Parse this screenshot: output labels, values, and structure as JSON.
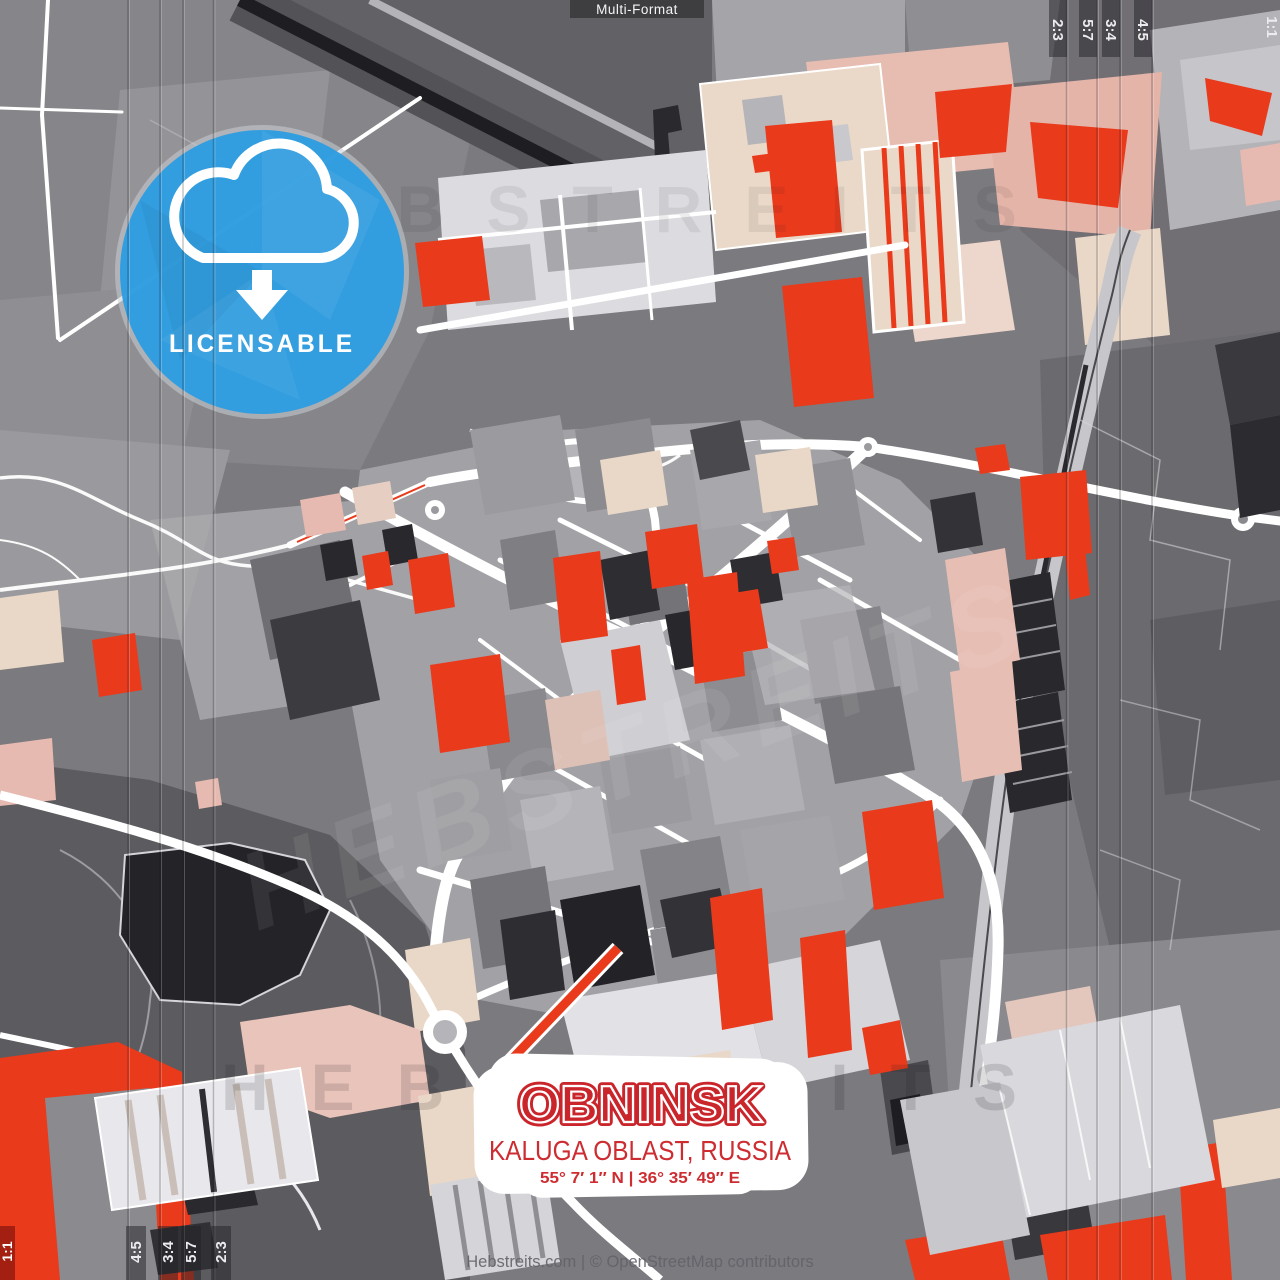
{
  "poster": {
    "format_label": "Multi-Format",
    "badge": {
      "label": "LICENSABLE",
      "color": "#2d9de1",
      "icon": "cloud-download-icon"
    },
    "title": {
      "city": "OBNINSK",
      "region": "KALUGA OBLAST, RUSSIA",
      "coordinates": "55° 7′ 1′′ N | 36° 35′ 49′′ E"
    },
    "watermark": {
      "text": "HEBSTREITS"
    },
    "footer_credit": "Hebstreits.com | © OpenStreetMap contributors",
    "format_marks": {
      "top_labels": [
        "2:3",
        "5:7",
        "3:4",
        "4:5"
      ],
      "bottom_labels": [
        "4:5",
        "3:4",
        "5:7",
        "2:3"
      ],
      "square_label": "1:1"
    },
    "map_palette": {
      "base_gray": "#7b7a7e",
      "dark_zone": "#5c5b5f",
      "accent_red": "#e93a1c",
      "beige": "#e9d8c7",
      "pink": "#e6bab0",
      "dark_block": "#2e2d31",
      "road_white": "#ffffff",
      "rail_gray": "#c7c6ca",
      "badge_blue": "#2d9de1",
      "title_red": "#c9252b"
    }
  }
}
